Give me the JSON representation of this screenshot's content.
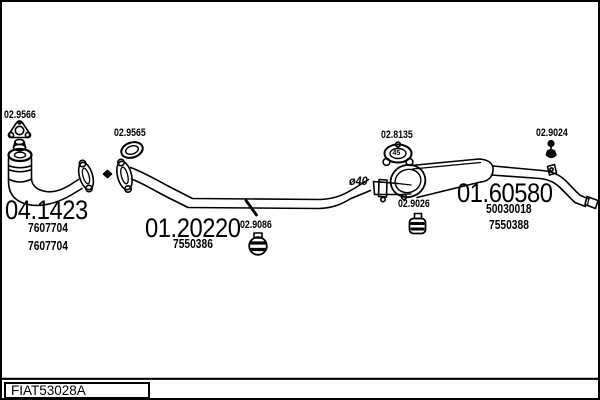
{
  "diagram": {
    "drawing_code": "FIAT53028A",
    "type": "exhaust-system-parts-diagram",
    "line_color": "#000000",
    "background": "#ffffff",
    "pipe_diameter_note": "ø40",
    "clamp_size_note": "45"
  },
  "parts": {
    "front_gasket": {
      "code": "02.9566"
    },
    "seal_ring": {
      "code": "02.9565"
    },
    "front_pipe": {
      "code": "04.1423",
      "refs": [
        "7607704",
        "7607704"
      ]
    },
    "centre_pipe": {
      "code": "01.20220",
      "refs": [
        "7550386"
      ]
    },
    "centre_mount": {
      "code": "02.9086"
    },
    "clamp": {
      "code": "02.8135",
      "size": "45"
    },
    "muffler_mount": {
      "code": "02.9026"
    },
    "rear_muffler": {
      "code": "01.60580",
      "refs": [
        "50030018",
        "7550388"
      ]
    },
    "rear_mount": {
      "code": "02.9024"
    }
  },
  "title_block": {
    "code": "FIAT53028A"
  }
}
